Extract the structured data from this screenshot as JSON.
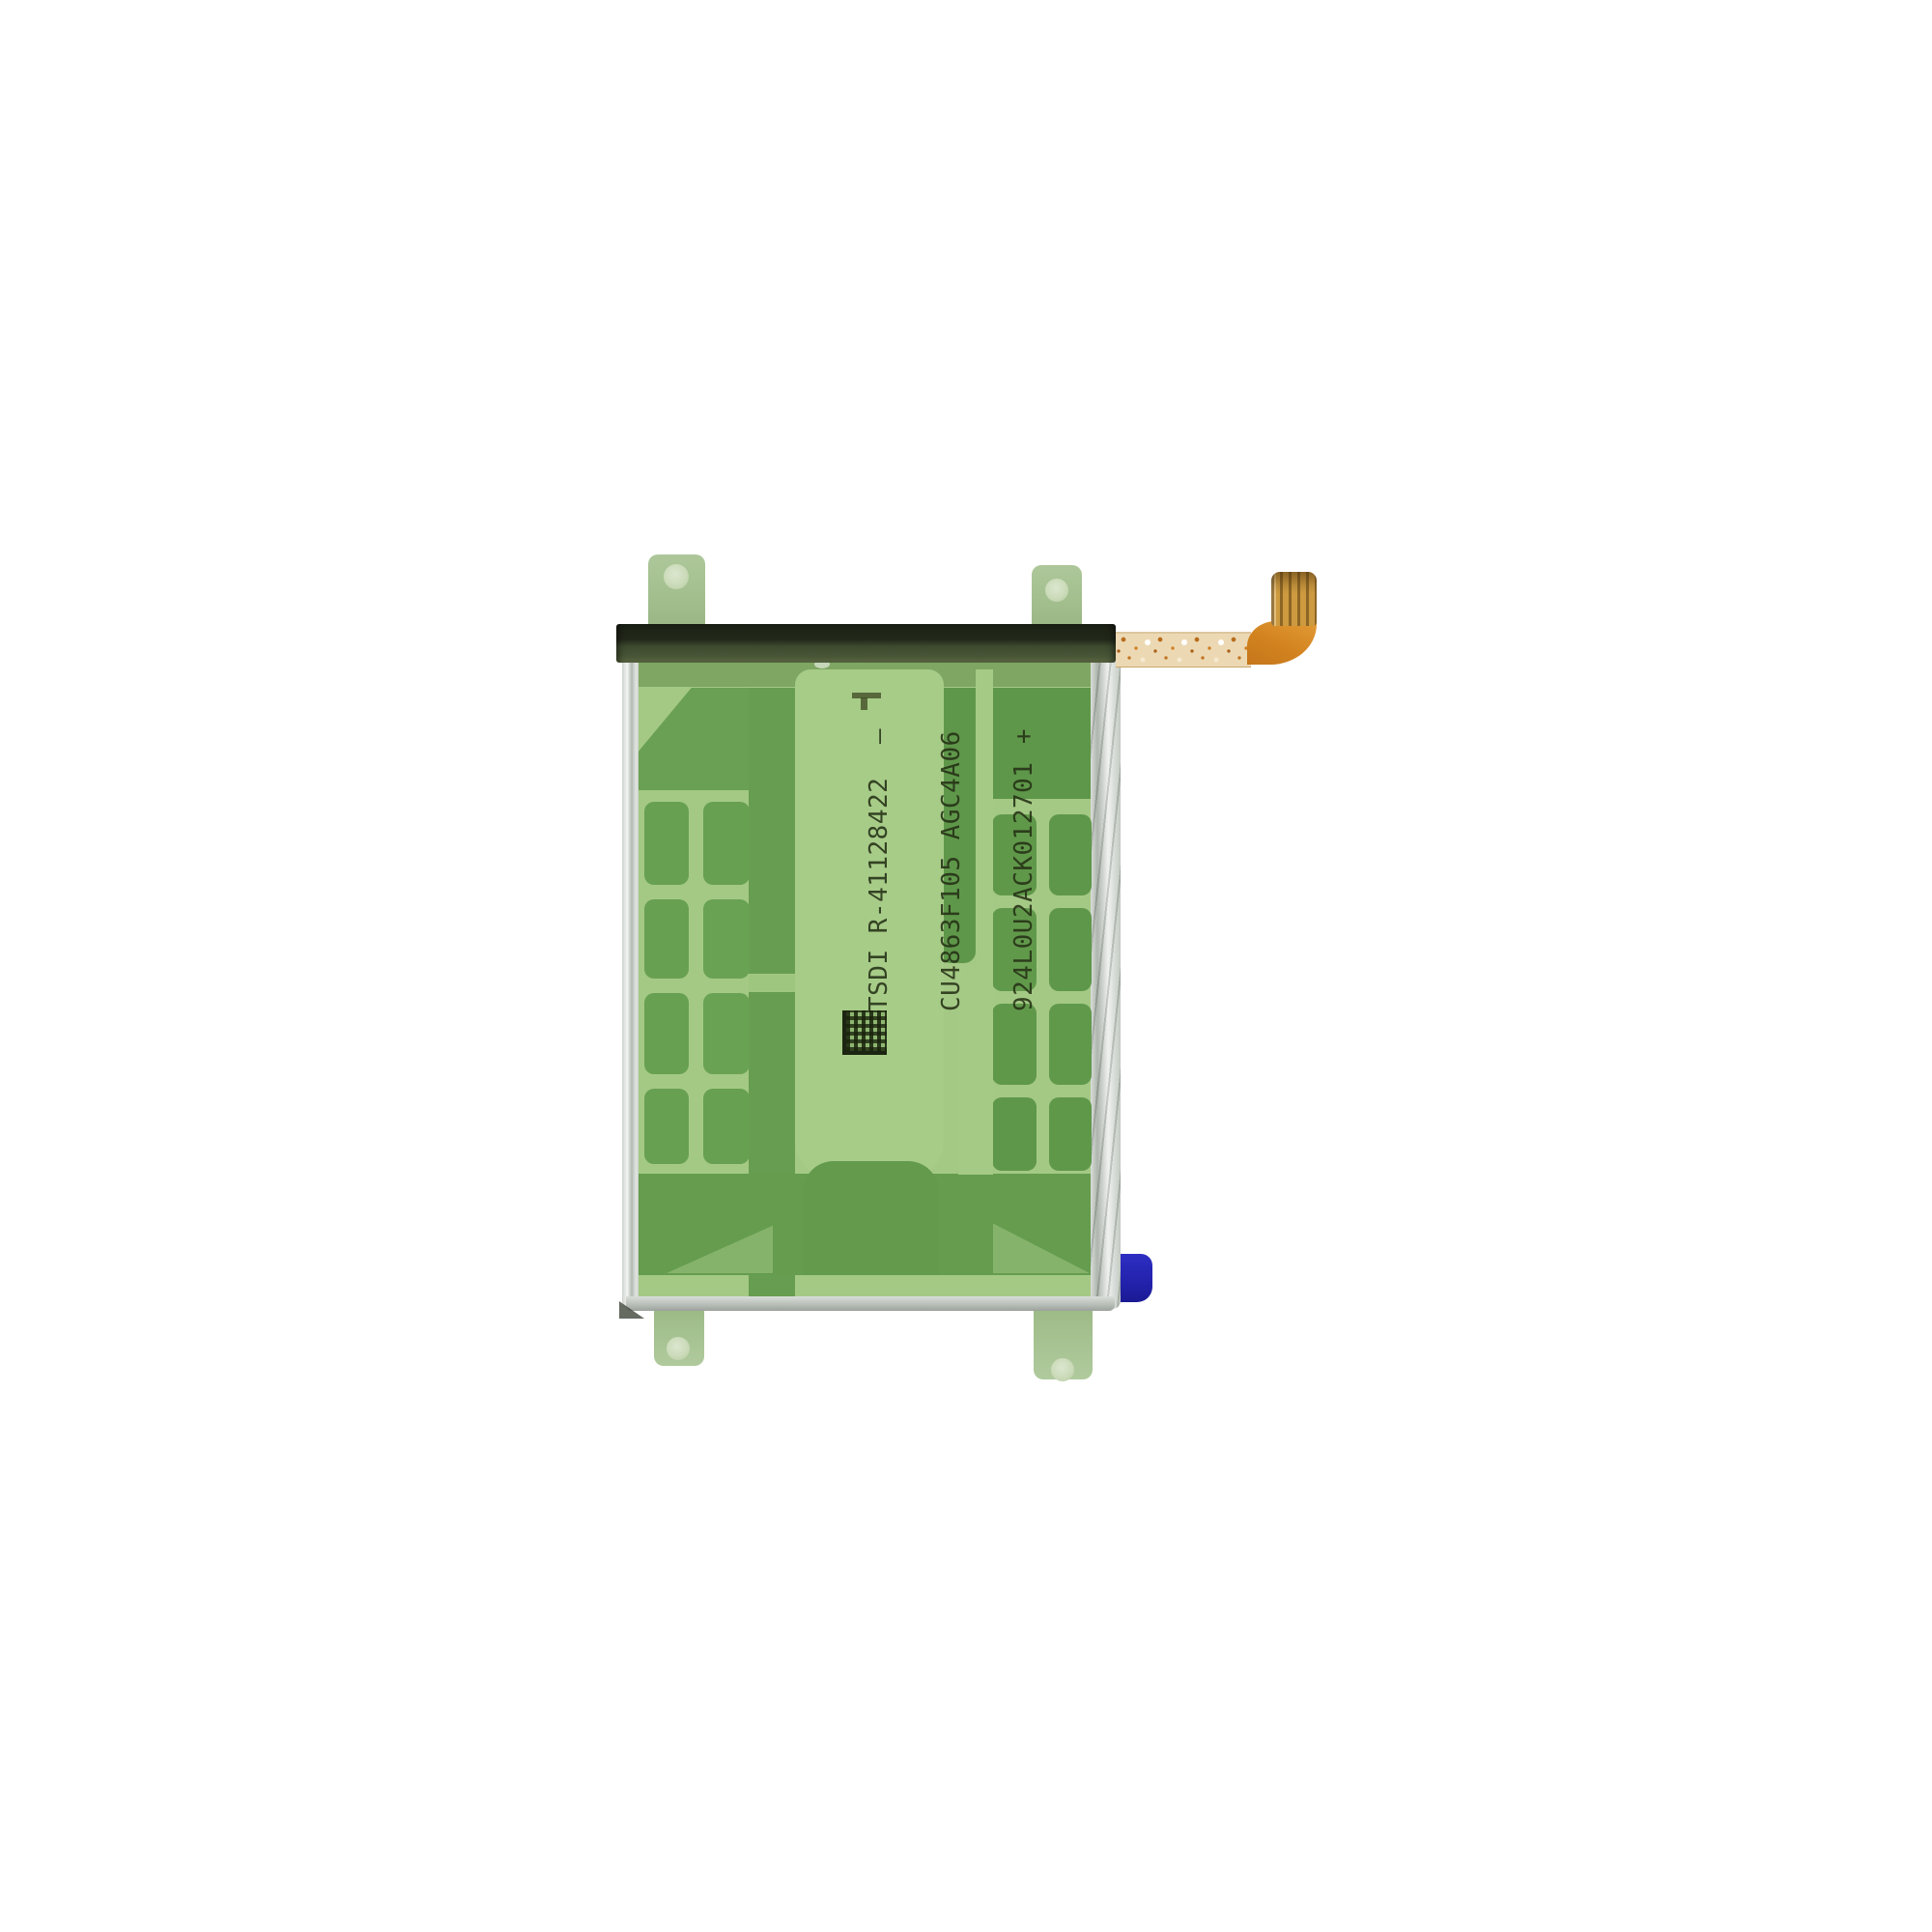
{
  "photo": {
    "subject": "Smartphone replacement battery with green adhesive film, top heat-seal bar, mounting tabs, orange flex cable with connector, and blue pull tab on white background",
    "background_color": "#ffffff"
  },
  "battery": {
    "print": {
      "lines": [
        {
          "code": "TSDI R-41128422",
          "mark": "–"
        },
        {
          "code": "CU4863F105 AGC4A06",
          "mark": ""
        },
        {
          "code": "924L0U2ACK012701",
          "mark": "+"
        }
      ],
      "ink_color": "#26331a"
    },
    "colors": {
      "film_light_green": "#a4c985",
      "film_dark_green": "#639a4c",
      "tab_green": "#a3bf8e",
      "seal_bar_dark": "#22281a",
      "seal_bar_olive": "#475435",
      "pouch_silver": "#c8cec8",
      "flex_orange": "#d2831f",
      "connector_gold": "#cd9a40",
      "pull_tab_blue": "#2323ae"
    }
  }
}
